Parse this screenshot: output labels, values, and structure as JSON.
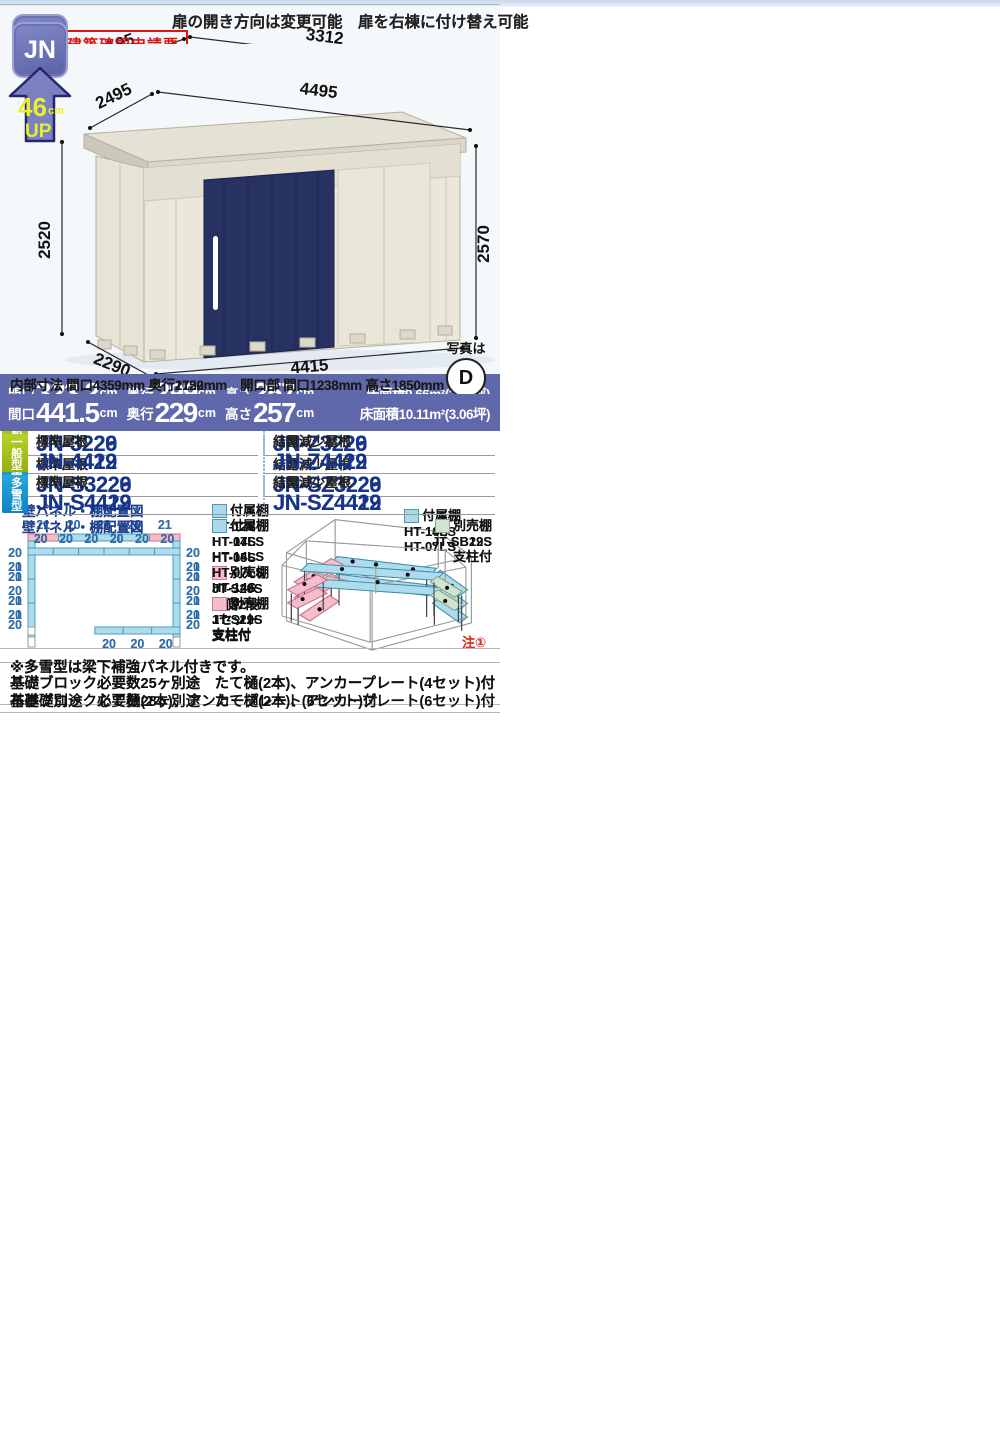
{
  "labels": {
    "jn": "JN",
    "up_value": "46",
    "up_unit": "cm",
    "up_word": "UP",
    "photo_is": "写真は",
    "wall_title": "壁パネル・棚配置図",
    "fuzoku": "付属棚",
    "betsubai": "別売棚",
    "ippan": "一般型",
    "tasetsu": "多雪型",
    "hyojun": "標準屋根",
    "ketsuro": "結露減少屋根",
    "maguchi": "間口",
    "okuyuki": "奥行",
    "takasa": "高さ",
    "cm": "cm",
    "door_note": "扉の開き方向は変更可能　扉を右棟に付け替え可能",
    "snow_note": "※多雪型は梁下補強パネル付きです。",
    "note1": "注①",
    "kenchiku": "建築確認申請要"
  },
  "colors": {
    "accent_bar": "#5e68aa",
    "ippan_badge": "#9fbe16",
    "tasetsu_badge": "#1590cb",
    "model_text": "#17348c",
    "red": "#dd1414",
    "fuzoku_fill": "#abd9ea",
    "betsubai_fill": "#f5bcca",
    "betsubai_green_fill": "#d2e4d0",
    "door_navy": "#273262",
    "door_tan": "#d39a62",
    "body_cream": "#ebe7da"
  },
  "panels": [
    {
      "photo_letter": "D",
      "dims": {
        "top_depth": "2827",
        "top_width": "3312",
        "left_h": "2520",
        "right_h": "2570",
        "bot_depth": "2622",
        "bot_width": "3232"
      },
      "inner_line": "内部寸法 間口3176mm 奥行2452mm　開口部 間口1772mm 高さ1850mm",
      "spec": {
        "m": "323.2",
        "o": "262.2",
        "t": "257",
        "floor": "床面積8.47m²(2.57坪)"
      },
      "models": {
        "i_std": "JN-3226",
        "i_ket": "JN-Z3226",
        "t_std": "JN-S3226",
        "t_ket": "JN-SZ3226"
      },
      "shelf": {
        "left": [
          "HT-12S",
          "HT-14LS",
          "HT-05S"
        ],
        "opt": [
          "JT-S26S",
          "片側2段",
          "1セット",
          "支柱付"
        ],
        "right_title": "付属棚",
        "right": [
          "HT-10S",
          "HT-07LS"
        ]
      },
      "wall": {
        "side_h": 24,
        "caps": true,
        "top": {
          "values": [
            "21",
            "20",
            "20",
            "20",
            "21"
          ],
          "colors": [
            "p",
            "b",
            "b",
            "b",
            "p"
          ]
        },
        "left": {
          "values": [
            "20",
            "21",
            "21",
            "20"
          ],
          "colors": [
            "b",
            "p",
            "p",
            "b"
          ]
        },
        "right": {
          "values": [
            "20",
            "21",
            "21",
            "20"
          ],
          "colors": [
            "b",
            "p",
            "p",
            "b"
          ]
        },
        "bottom": null
      },
      "footer": "基礎ブロック必要数25ヶ別途　たて樋(2本)、アンカープレート(4セット)付"
    },
    {
      "photo_letter": "T",
      "dims": {
        "top_depth": "3195",
        "top_width": "3312",
        "left_h": "2520",
        "right_h": "2570",
        "bot_depth": "2990",
        "bot_width": "3232"
      },
      "inner_line": "内部寸法 間口3176mm 奥行2820mm　開口部 間口1772mm 高さ1850mm",
      "spec": {
        "m": "323.2",
        "o": "299",
        "t": "257",
        "floor": "床面積9.66m²(2.93坪)"
      },
      "models": {
        "i_std": "JN-3229",
        "i_ket": "JN-Z3229",
        "t_std": "JN-S3229",
        "t_ket": "JN-SZ3229"
      },
      "shelf": {
        "left": [
          "HT-12S",
          "HT-14LS",
          "HT-05S"
        ],
        "opt": [
          "JT-S29S",
          "片側2段",
          "1セット",
          "支柱付"
        ],
        "right_title": "付属棚",
        "right": [
          "HT-14LS",
          "HT-07LS"
        ]
      },
      "wall": {
        "side_h": 24,
        "caps": true,
        "top": {
          "values": [
            "21",
            "20",
            "20",
            "20",
            "21"
          ],
          "colors": [
            "p",
            "b",
            "b",
            "b",
            "p"
          ]
        },
        "left": {
          "values": [
            "20",
            "20",
            "20",
            "20"
          ],
          "colors": [
            "b",
            "b",
            "b",
            "b"
          ]
        },
        "right": {
          "values": [
            "20",
            "20",
            "20",
            "20"
          ],
          "colors": [
            "b",
            "b",
            "b",
            "b"
          ]
        },
        "bottom": null
      },
      "footer": "基礎ブロック必要数25ヶ別途　たて樋(2本)、アンカープレート(4セット)付"
    },
    {
      "photo_letter": "W",
      "dims": {
        "top_depth": "2127",
        "top_width": "4495",
        "left_h": "2520",
        "right_h": "2570",
        "bot_depth": "1922",
        "bot_width": "4415"
      },
      "inner_line": "内部寸法 間口4359mm 奥行1752mm　開口部 間口1238mm 高さ1850mm",
      "spec": {
        "m": "441.5",
        "o": "192.2",
        "t": "257",
        "floor": "床面積8.49m²(2.57坪)"
      },
      "models": {
        "i_std": "JN-4419",
        "i_ket": "JN-Z4419",
        "t_std": "JN-S4419",
        "t_ket": "JN-SZ4419"
      },
      "shelf": {
        "left": [
          "HT-07S",
          "HT-14LS",
          "HT-07LS",
          "HT-14S"
        ],
        "opt": [
          "JT-S19S",
          "支柱付"
        ],
        "right_title": "別売棚",
        "right": [
          "JT-SB19S",
          "支柱付"
        ]
      },
      "wall": {
        "side_h": 24,
        "caps": false,
        "top": {
          "values": [
            "20",
            "20",
            "20",
            "20",
            "20",
            "20"
          ],
          "colors": [
            "b",
            "b",
            "b",
            "b",
            "b",
            "b"
          ]
        },
        "left": {
          "values": [
            "21",
            "20",
            "21"
          ],
          "colors": [
            "p",
            "b",
            "p"
          ]
        },
        "right": {
          "values": [
            "21",
            "20",
            "21"
          ],
          "colors": [
            "p",
            "b",
            "p"
          ]
        },
        "bottom": {
          "values": [
            "20",
            "20",
            "20"
          ],
          "colors": [
            "b",
            "b",
            "b"
          ]
        }
      },
      "footer": "基礎ブロック必要数28ヶ別途　たて樋(2本)、アンカープレート(6セット)付"
    },
    {
      "photo_letter": "D",
      "dims": {
        "top_depth": "2495",
        "top_width": "4495",
        "left_h": "2520",
        "right_h": "2570",
        "bot_depth": "2290",
        "bot_width": "4415"
      },
      "inner_line": "内部寸法 間口4359mm 奥行2120mm　開口部 間口1238mm 高さ1850mm",
      "spec": {
        "m": "441.5",
        "o": "229",
        "t": "257",
        "floor": "床面積10.11m²(3.06坪)"
      },
      "models": {
        "i_std": "JN-4422",
        "i_ket": "JN-Z4422",
        "t_std": "JN-S4422",
        "t_ket": "JN-SZ4422"
      },
      "shelf": {
        "left": [
          "HT-07S",
          "HT-14LS",
          "HT-07LS",
          "HT-14S"
        ],
        "opt": [
          "JT-S22S",
          "支柱付"
        ],
        "right_title": "別売棚",
        "right": [
          "JT-SB22S",
          "支柱付"
        ]
      },
      "wall": {
        "side_h": 24,
        "caps": false,
        "top": {
          "values": [
            "20",
            "20",
            "20",
            "20",
            "20",
            "20"
          ],
          "colors": [
            "b",
            "b",
            "b",
            "b",
            "b",
            "b"
          ]
        },
        "left": {
          "values": [
            "20",
            "20",
            "20"
          ],
          "colors": [
            "b",
            "b",
            "b"
          ]
        },
        "right": {
          "values": [
            "20",
            "20",
            "20"
          ],
          "colors": [
            "b",
            "b",
            "b"
          ]
        },
        "bottom": {
          "values": [
            "20",
            "20",
            "20"
          ],
          "colors": [
            "b",
            "b",
            "b"
          ]
        }
      },
      "red_note": {
        "l1": "＊布基礎で設置する場合は、",
        "l1r": "アンカー",
        "l2": "ボルトセット（別売）が必要です。"
      },
      "footer": "布基礎別途　たて樋(2本)、アンカープレート(6セット)付"
    }
  ]
}
